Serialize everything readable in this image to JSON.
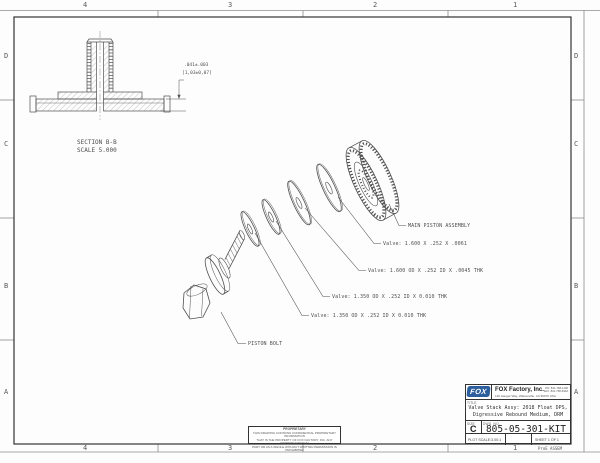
{
  "frame": {
    "zones_top": [
      "4",
      "3",
      "2",
      "1"
    ],
    "zones_bottom": [
      "4",
      "3",
      "2",
      "1"
    ],
    "zones_left": [
      "D",
      "C",
      "B",
      "A"
    ],
    "zones_right": [
      "D",
      "C",
      "B",
      "A"
    ],
    "margin_note": "ProE ASSEM"
  },
  "section_view": {
    "title": "SECTION  B-B",
    "scale": "SCALE  5.000",
    "dim_in": ".041±.003",
    "dim_mm": "[1,03±0,07]"
  },
  "callouts": {
    "main_piston": "MAIN PISTON ASSEMBLY",
    "valve_1": "Valve: 1.600 X .252 X .0061",
    "valve_2": "Valve: 1.600 OD X .252 ID X .0045 THK",
    "valve_3": "Valve: 1.350 OD X .252 ID X 0.010 THK",
    "valve_4": "Valve: 1.350 OD X .252 ID X 0.010 THK",
    "piston_bolt": "PISTON BOLT"
  },
  "title_block": {
    "logo": "FOX",
    "company": "FOX Factory, Inc.",
    "address": "130 Hangar Way, Watsonville, CA 95076 USA",
    "phone": "PH: 831-768-1100",
    "fax": "FAX: 831-768-9342",
    "title_label": "TITLE",
    "title_line1": "Valve Stack Assy: 2018 Float DPS,",
    "title_line2": "Digressive Rebound Medium, DRM",
    "size_label": "SIZE",
    "size_value": "C",
    "dwg_label": "DWG. NO.",
    "dwg_number": "805-05-301-KIT",
    "plot_scale": "PLOT SCALE:3.00:1",
    "sheet_info": "SHEET 1 OF 1"
  },
  "proprietary_note": {
    "line1": "PROPRIETARY",
    "line2": "THIS DRAWING CONTAINS CONFIDENTIAL PROPRIETARY INFORMATION",
    "line3": "THAT IS THE PROPERTY OF FOX FACTORY, INC. ANY REPRODUCTION IN",
    "line4": "PART OR AS A WHOLE WITHOUT WRITTEN PERMISSION IS PROHIBITED"
  }
}
